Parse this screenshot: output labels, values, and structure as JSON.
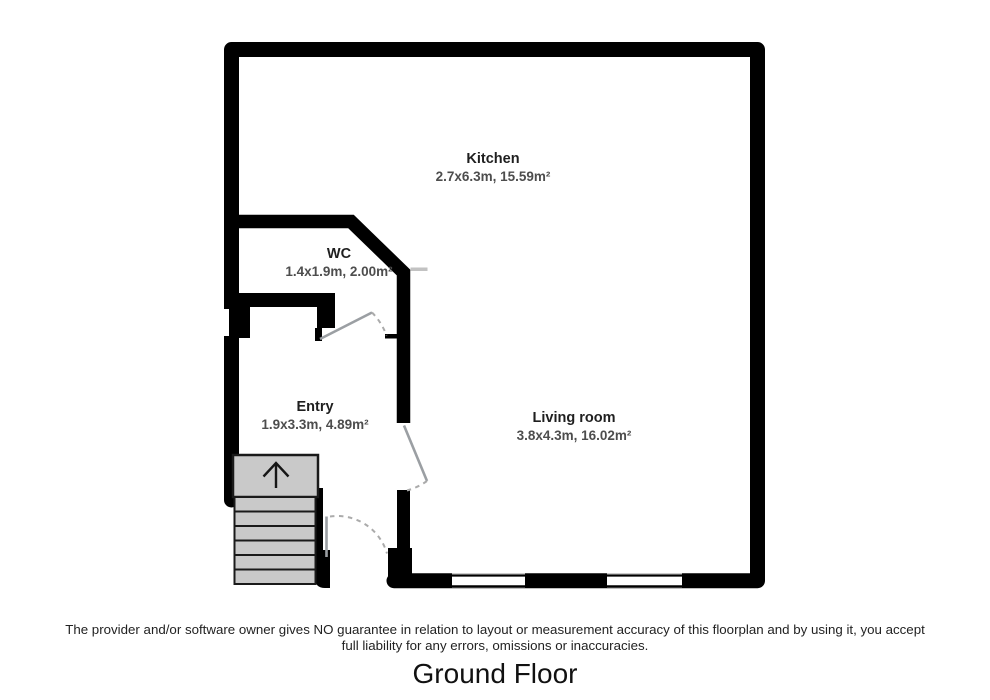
{
  "floorplan": {
    "title": "Ground Floor",
    "disclaimer": {
      "line1": "The provider and/or software owner gives NO guarantee in relation to layout or measurement accuracy of this floorplan and by using it, you accept",
      "line2": "full liability for any errors, omissions or inaccuracies."
    },
    "rooms": [
      {
        "name": "Kitchen",
        "dims": "2.7x6.3m, 15.59m²"
      },
      {
        "name": "WC",
        "dims": "1.4x1.9m, 2.00m²"
      },
      {
        "name": "Entry",
        "dims": "1.9x3.3m, 4.89m²"
      },
      {
        "name": "Living room",
        "dims": "3.8x4.3m, 16.02m²"
      }
    ],
    "stairs": {
      "direction_icon": "up-arrow"
    },
    "colors": {
      "wall": "#000000",
      "stair_fill": "#c9c9c9",
      "stair_border": "#1a1a1a",
      "door_leaf": "#9b9fa3",
      "door_arc": "#ababab",
      "dims_text": "#4d4d4d",
      "background": "#ffffff"
    }
  }
}
